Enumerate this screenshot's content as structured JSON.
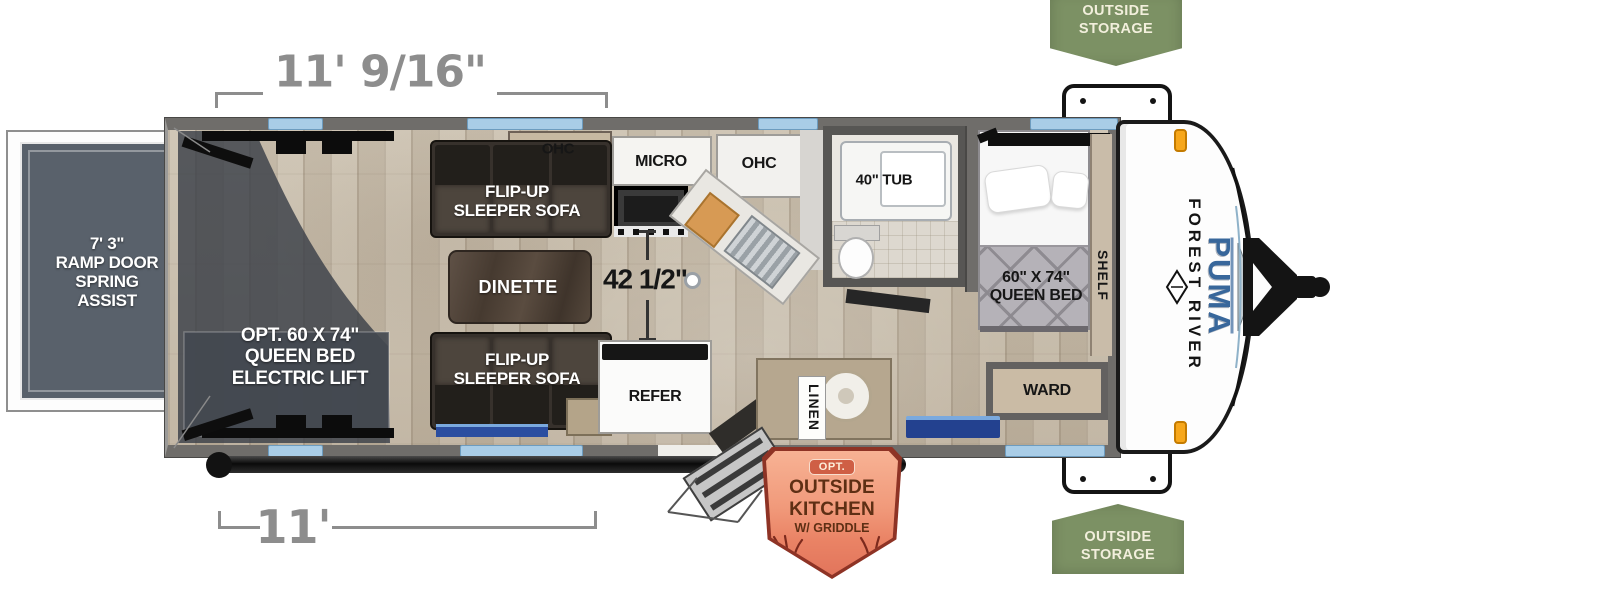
{
  "meta": {
    "title": "Forest River Puma toy hauler floorplan"
  },
  "colors": {
    "window_blue": "#a9cde7",
    "wall_gray": "#6f6d6a",
    "dimension_gray": "#8d8d8d",
    "badge_green": "#7c9164",
    "badge_text_cream": "#f2efdc",
    "kitchen_badge_border": "#8e3325",
    "kitchen_badge_fill": "#f19a7b",
    "kitchen_badge_text": "#5e2f14",
    "puma_blue": "#38679b"
  },
  "dimensions": {
    "top_width": "11' 9/16\"",
    "bottom_width": "11'",
    "kitchen_clearance": "42 1/2\""
  },
  "badges": {
    "storage_top": "OUTSIDE\nSTORAGE",
    "storage_bottom": "OUTSIDE\nSTORAGE",
    "outside_kitchen": {
      "opt": "OPT.",
      "line1": "OUTSIDE",
      "line2": "KITCHEN",
      "line3": "W/ GRIDDLE"
    }
  },
  "exterior": {
    "ramp_door": "7' 3\"\nRAMP DOOR\nSPRING\nASSIST",
    "brand": "FOREST RIVER",
    "model": "PUMA"
  },
  "interior": {
    "cargo_bed": "OPT. 60 X 74\"\nQUEEN BED\nELECTRIC LIFT",
    "sofa_top": "FLIP-UP\nSLEEPER SOFA",
    "sofa_bottom": "FLIP-UP\nSLEEPER SOFA",
    "ohc_sofa": "OHC",
    "micro": "MICRO",
    "ohc_kitchen": "OHC",
    "dinette": "DINETTE",
    "refer": "REFER",
    "linen": "LINEN",
    "tub": "40\" TUB",
    "queen_bed": "60\" X 74\"\nQUEEN BED",
    "shelf": "SHELF",
    "ward": "WARD"
  }
}
